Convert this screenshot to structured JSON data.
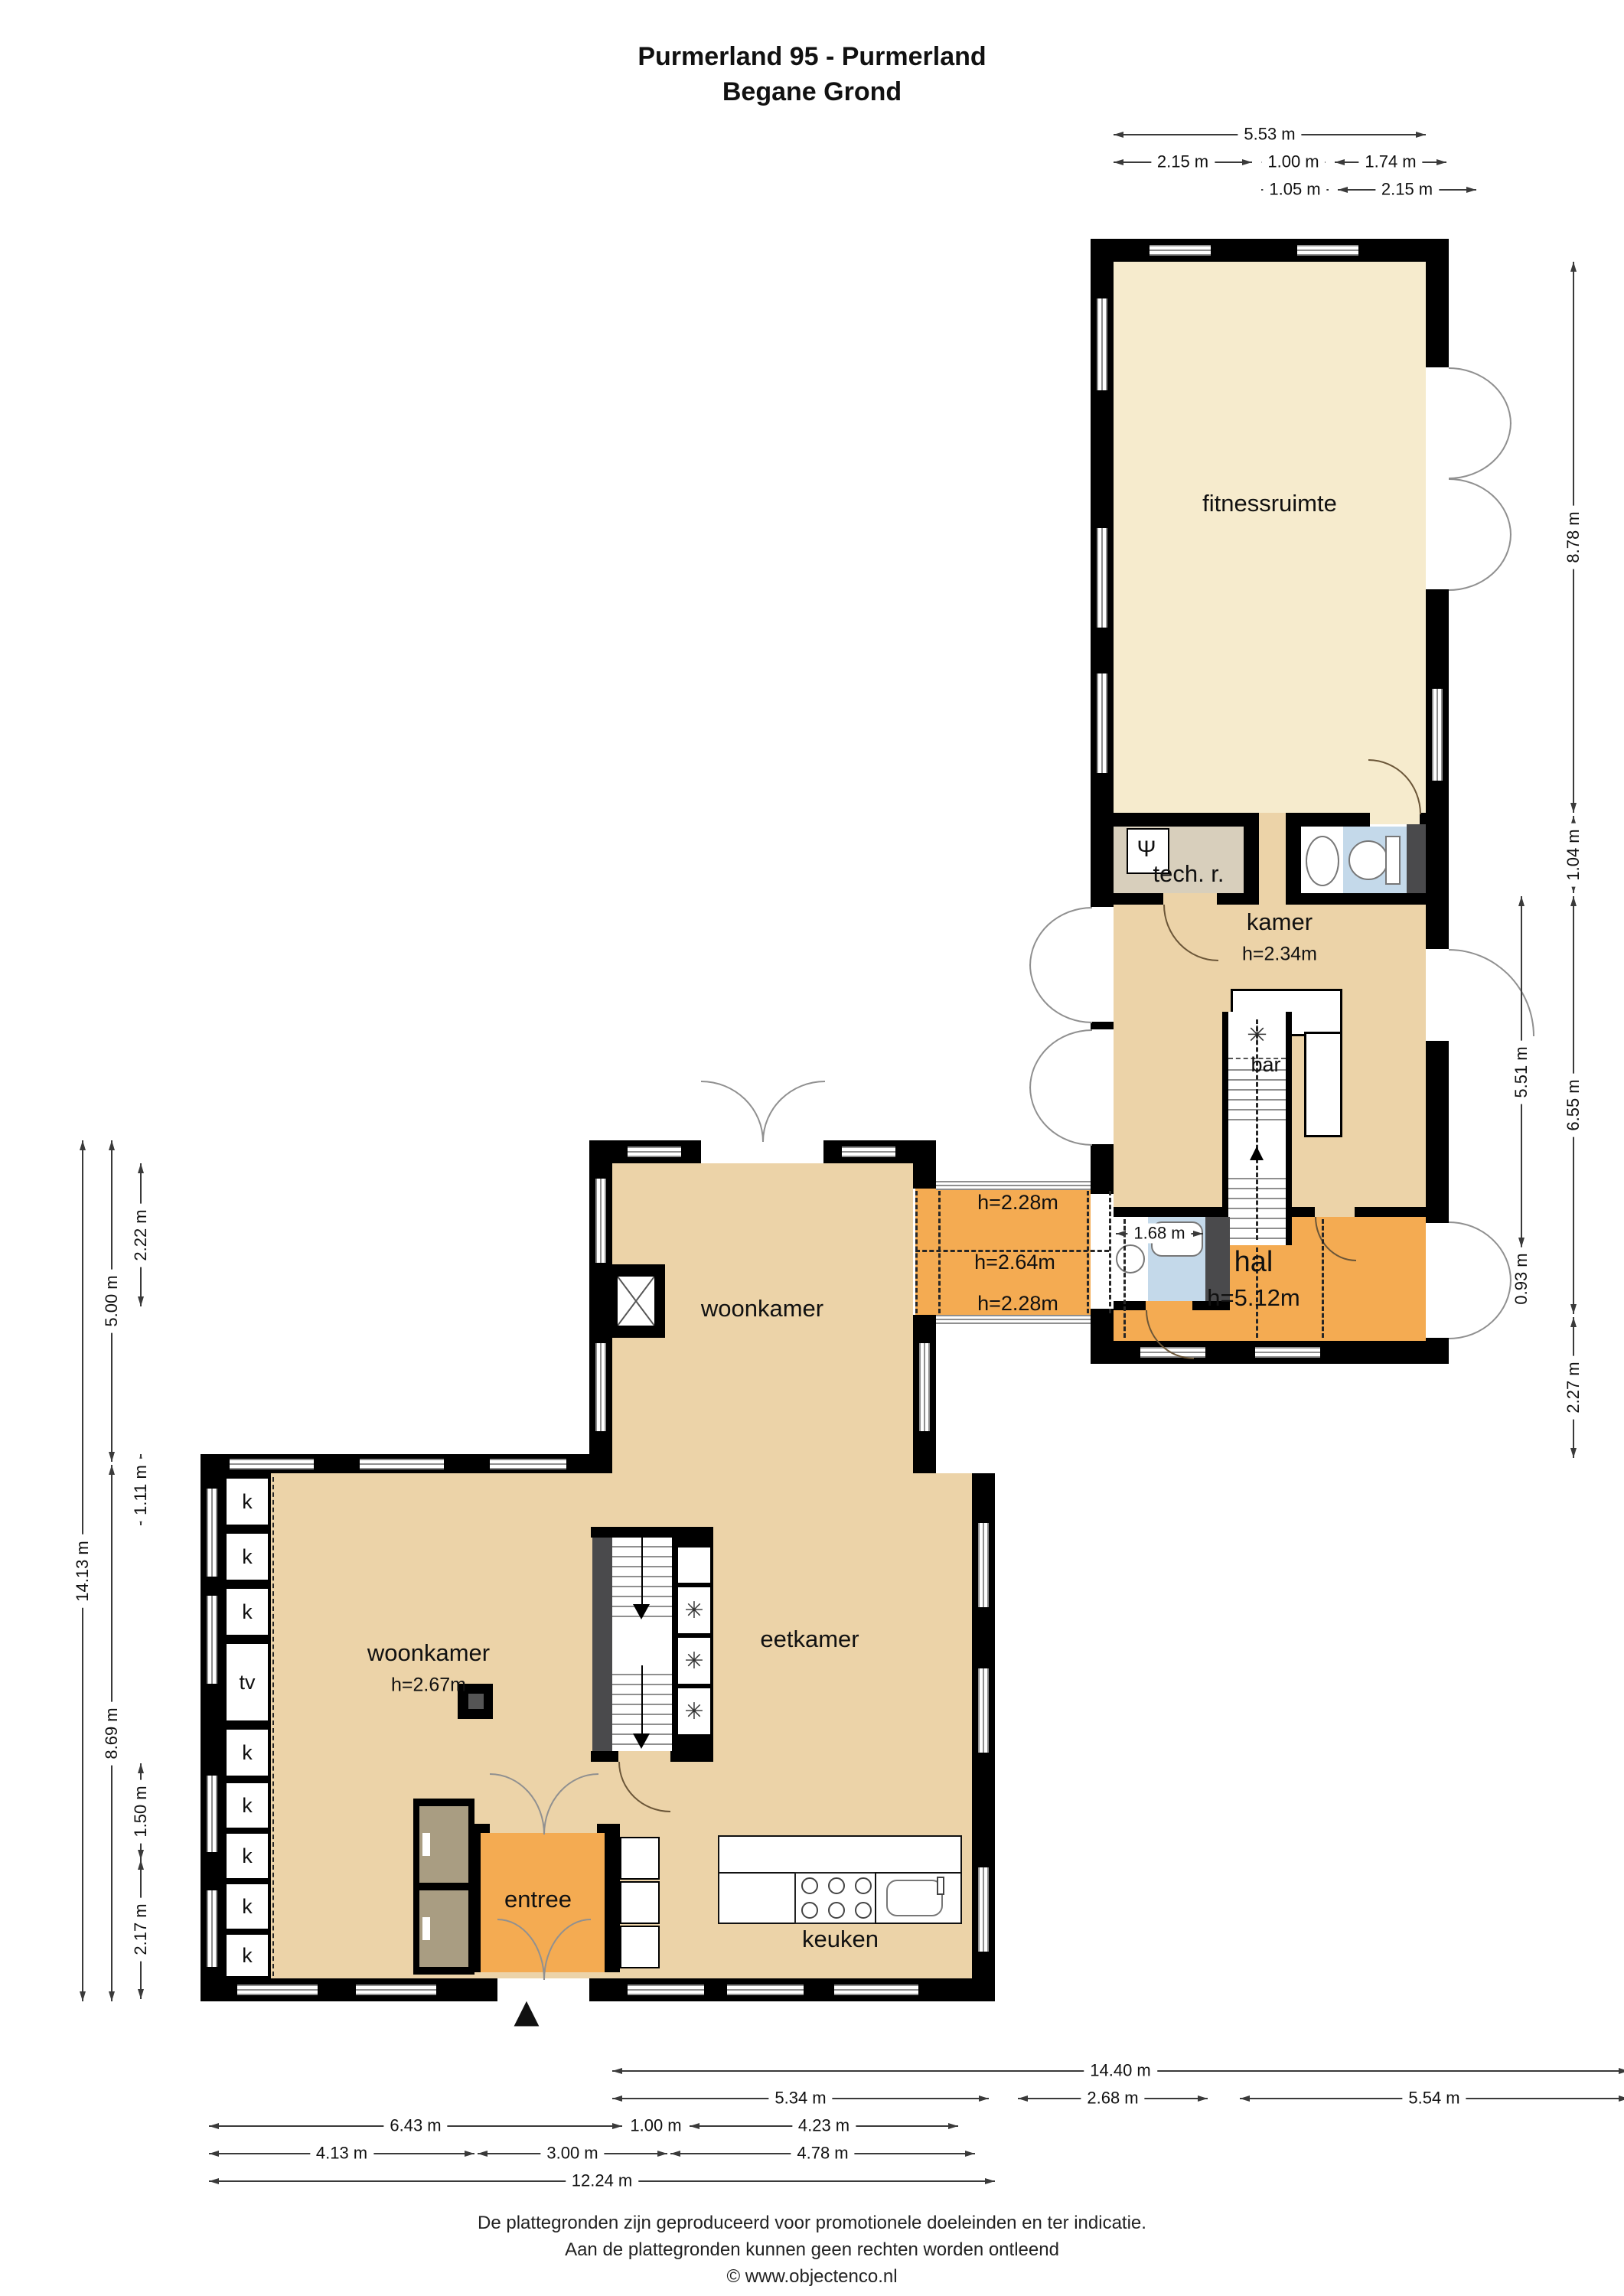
{
  "title": {
    "line1": "Purmerland 95 - Purmerland",
    "line2": "Begane Grond"
  },
  "rooms": {
    "fitnessruimte": {
      "label": "fitnessruimte"
    },
    "tech_room": {
      "label": "tech. r."
    },
    "kamer": {
      "label": "kamer",
      "height": "h=2.34m"
    },
    "bar": {
      "label": "bar"
    },
    "hal": {
      "label": "hal",
      "height": "h=5.12m"
    },
    "corridor": {
      "height_top": "h=2.28m",
      "height_mid": "h=2.64m",
      "height_bottom": "h=2.28m"
    },
    "woonkamer_upper": {
      "label": "woonkamer"
    },
    "woonkamer_lower": {
      "label": "woonkamer",
      "height": "h=2.67m"
    },
    "eetkamer": {
      "label": "eetkamer"
    },
    "entree": {
      "label": "entree"
    },
    "keuken": {
      "label": "keuken"
    }
  },
  "closets": {
    "items": [
      {
        "label": "k"
      },
      {
        "label": "k"
      },
      {
        "label": "k"
      },
      {
        "label": "tv"
      },
      {
        "label": "k"
      },
      {
        "label": "k"
      },
      {
        "label": "k"
      },
      {
        "label": "k"
      },
      {
        "label": "k"
      }
    ]
  },
  "dimensions": {
    "top": {
      "total": "5.53 m",
      "row2": [
        "2.15 m",
        "1.00 m",
        "1.74 m"
      ],
      "row3": [
        "1.05 m",
        "2.15 m"
      ]
    },
    "right_outer": [
      "8.78 m",
      "1.04 m",
      "6.55 m",
      "2.27 m"
    ],
    "right_inner": [
      "5.51 m",
      "0.93 m"
    ],
    "bath_width": "1.68 m",
    "left_total": "14.13 m",
    "left_col2": [
      "5.00 m",
      "8.69 m"
    ],
    "left_col3": [
      "2.22 m",
      "1.11 m",
      "1.50 m",
      "2.17 m"
    ],
    "bottom_total": "14.40 m",
    "bottom_row2": [
      "5.34 m",
      "2.68 m",
      "5.54 m"
    ],
    "bottom_row3": [
      "6.43 m",
      "1.00 m",
      "4.23 m"
    ],
    "bottom_row4": [
      "4.13 m",
      "3.00 m",
      "4.78 m"
    ],
    "bottom_row5": "12.24 m"
  },
  "icons": {
    "north_arrow": "▲",
    "fan": "✳",
    "boiler": "Ψ"
  },
  "footer": {
    "line1": "De plattegronden zijn geproduceerd voor promotionele doeleinden en ter indicatie.",
    "line2": "Aan de plattegronden kunnen geen rechten worden ontleend",
    "line3": "© www.objectenco.nl"
  },
  "colors": {
    "floor_cream": "#f6ebcd",
    "floor_tan": "#ecd3a8",
    "floor_orange": "#f4ab52",
    "floor_tech": "#d8cfbc",
    "floor_bath": "#c4d9ea",
    "closet_tan": "#a99d82",
    "wall": "#000000",
    "dark_gray": "#4a4a4c"
  }
}
